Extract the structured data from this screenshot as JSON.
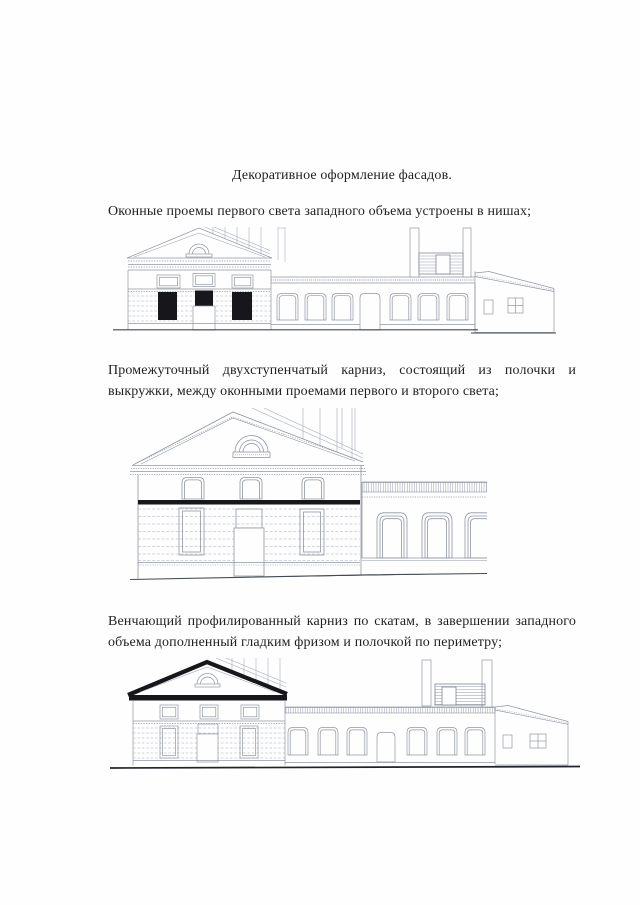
{
  "document": {
    "title": "Декоративное оформление фасадов.",
    "paragraphs": [
      {
        "lines": [
          "Оконные проемы первого света западного объема устроены в нишах;"
        ]
      },
      {
        "lines": [
          "Промежуточный двухступенчатый карниз, состоящий из полочки и",
          "выкружки, между оконными проемами первого и второго света;"
        ]
      },
      {
        "lines": [
          "Венчающий профилированный карниз по скатам, в завершении западного",
          "объема дополненный гладким фризом и полочкой по периметру;"
        ]
      }
    ],
    "figures": [
      {
        "name": "facade-elevation-window-niches"
      },
      {
        "name": "facade-fragment-intermediate-cornice"
      },
      {
        "name": "facade-elevation-crowning-cornice"
      }
    ],
    "colors": {
      "paper": "#fefefe",
      "ink": "#1f1f23",
      "drawing_line": "#9096a3",
      "drawing_dark": "#17171b"
    }
  }
}
